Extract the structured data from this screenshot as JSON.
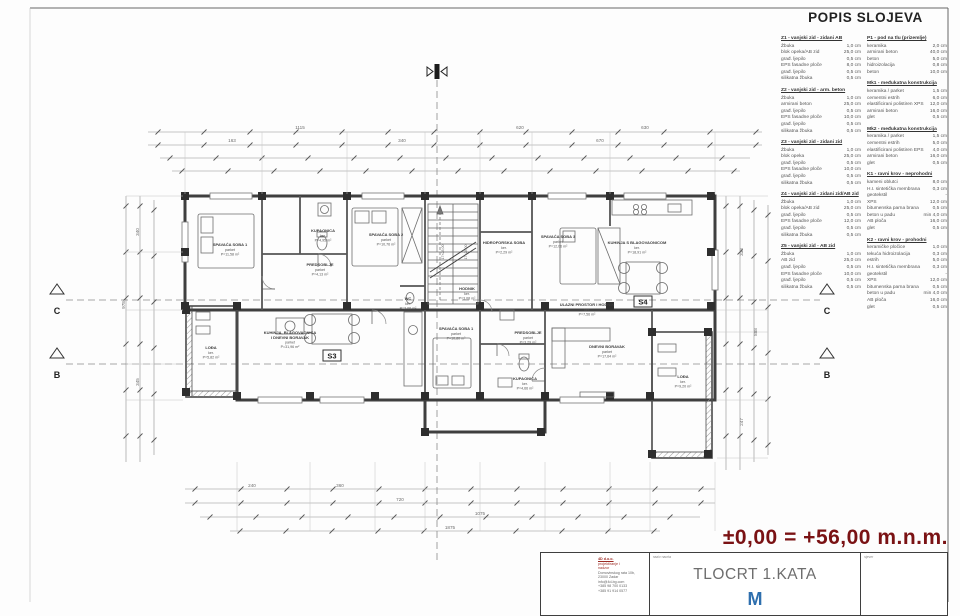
{
  "sheet": {
    "legend_title": "POPIS SLOJEVA",
    "elevation_note": "±0,00 = +56,00  m.n.m.",
    "title_block": {
      "drawing_title": "TLOCRT 1.KATA",
      "scale_prefix": "M",
      "title_cell_label": "naziv nacrta",
      "north_cell_label": "sjever",
      "logo_letter": "D",
      "company": {
        "red_lines": [
          "4D d.o.o.",
          "projektiranje i",
          "nadzor"
        ],
        "gray_lines": [
          "Domovinskog rata 10b,",
          "23000 Zadar",
          "info@4d-bg.com",
          "+385 98 700 0133",
          "+385 91 914 0577"
        ]
      }
    },
    "accent_colors": {
      "red": "#7a1214",
      "blue": "#2e6fae",
      "line": "#3f3f3f"
    }
  },
  "legend": {
    "left": [
      {
        "title": "Z1 - vanjski zid - zidani AB",
        "items": [
          [
            "Žbuka",
            "1,0 cm"
          ],
          [
            "blok opeka/AB zid",
            "25,0 cm"
          ],
          [
            "građ. ljepilo",
            "0,5 cm"
          ],
          [
            "EPS fasadne ploče",
            "8,0 cm"
          ],
          [
            "građ. ljepilo",
            "0,5 cm"
          ],
          [
            "silikatna žbuka",
            "0,5 cm"
          ]
        ]
      },
      {
        "title": "Z2 - vanjski zid - arm. beton",
        "items": [
          [
            "Žbuka",
            "1,0 cm"
          ],
          [
            "armirani beton",
            "25,0 cm"
          ],
          [
            "građ. ljepilo",
            "0,5 cm"
          ],
          [
            "EPS fasadne ploče",
            "10,0 cm"
          ],
          [
            "građ. ljepilo",
            "0,5 cm"
          ],
          [
            "silikatna žbuka",
            "0,5 cm"
          ]
        ]
      },
      {
        "title": "Z3 - vanjski zid - zidani zid",
        "items": [
          [
            "Žbuka",
            "1,0 cm"
          ],
          [
            "blok opeka",
            "25,0 cm"
          ],
          [
            "građ. ljepilo",
            "0,5 cm"
          ],
          [
            "EPS fasadne ploče",
            "10,0 cm"
          ],
          [
            "građ. ljepilo",
            "0,5 cm"
          ],
          [
            "silikatna žbuka",
            "0,5 cm"
          ]
        ]
      },
      {
        "title": "Z4 - vanjski zid - zidani zid/AB zid",
        "items": [
          [
            "Žbuka",
            "1,0 cm"
          ],
          [
            "blok opeka/AB zid",
            "25,0 cm"
          ],
          [
            "građ. ljepilo",
            "0,5 cm"
          ],
          [
            "EPS fasadne ploče",
            "12,0 cm"
          ],
          [
            "građ. ljepilo",
            "0,5 cm"
          ],
          [
            "silikatna žbuka",
            "0,5 cm"
          ]
        ]
      },
      {
        "title": "Z5 - vanjski zid - AB zid",
        "items": [
          [
            "Žbuka",
            "1,0 cm"
          ],
          [
            "AB zid",
            "25,0 cm"
          ],
          [
            "građ. ljepilo",
            "0,5 cm"
          ],
          [
            "EPS fasadne ploče",
            "10,0 cm"
          ],
          [
            "građ. ljepilo",
            "0,5 cm"
          ],
          [
            "silikatna žbuka",
            "0,5 cm"
          ]
        ]
      }
    ],
    "right": [
      {
        "title": "P1 - pod na tlu (prizemlje)",
        "items": [
          [
            "keramika",
            "2,0 cm"
          ],
          [
            "armirani beton",
            "40,0 cm"
          ],
          [
            "beton",
            "5,0 cm"
          ],
          [
            "hidroizolacija",
            "0,8 cm"
          ],
          [
            "beton",
            "10,0 cm"
          ]
        ]
      },
      {
        "title": "Mk1 - međukatna konstrukcija",
        "items": [
          [
            "keramika / parket",
            "1,5 cm"
          ],
          [
            "cementni estrih",
            "6,0 cm"
          ],
          [
            "elastificirani polistiren XPS",
            "12,0 cm"
          ],
          [
            "armirani beton",
            "16,0 cm"
          ],
          [
            "glet",
            "0,5 cm"
          ]
        ]
      },
      {
        "title": "Mk2 - međukatna konstrukcija",
        "items": [
          [
            "keramika / parket",
            "1,5 cm"
          ],
          [
            "cementni estrih",
            "5,0 cm"
          ],
          [
            "elastificirani polistiren EPS",
            "4,0 cm"
          ],
          [
            "armirani beton",
            "16,0 cm"
          ],
          [
            "glet",
            "0,5 cm"
          ]
        ]
      },
      {
        "title": "K1 - ravni krov - neprohodni",
        "items": [
          [
            "kameni oblutci",
            "8,0 cm"
          ],
          [
            "H.I. sintetička membrana",
            "0,3 cm"
          ],
          [
            "geotekstil",
            "-"
          ],
          [
            "XPS",
            "12,0 cm"
          ],
          [
            "bitumenska parna brana",
            "0,5 cm"
          ],
          [
            "beton u padu",
            "min 4,0 cm"
          ],
          [
            "AB ploča",
            "16,0 cm"
          ],
          [
            "glet",
            "0,5 cm"
          ]
        ]
      },
      {
        "title": "K2 - ravni krov - prohodni",
        "items": [
          [
            "keramičke pločice",
            "1,0 cm"
          ],
          [
            "tekuća hidroizolacija",
            "0,3 cm"
          ],
          [
            "estrih",
            "5,0 cm"
          ],
          [
            "H.I. sintetička membrana",
            "0,3 cm"
          ],
          [
            "geotekstil",
            "-"
          ],
          [
            "XPS",
            "12,0 cm"
          ],
          [
            "bitumenska parna brana",
            "0,5 cm"
          ],
          [
            "beton u padu",
            "min 4,0 cm"
          ],
          [
            "AB ploča",
            "16,0 cm"
          ],
          [
            "glet",
            "0,5 cm"
          ]
        ]
      }
    ]
  },
  "plan": {
    "unit_labels": {
      "s3": "S3",
      "s4": "S4"
    },
    "section_markers": {
      "b": "B",
      "c": "C"
    },
    "stairs_text": "17×28,00",
    "dims": {
      "top": [
        "1115",
        "620",
        "630",
        "163",
        "340",
        "670"
      ],
      "bottom": [
        "240",
        "360",
        "720",
        "1075",
        "1875"
      ],
      "left": [
        "340",
        "978",
        "345"
      ],
      "right": [
        "333",
        "888",
        "247"
      ]
    },
    "rooms": [
      {
        "name": "SPAVAĆA SOBA 1",
        "floor": "parket",
        "area": "P=11,58 m²"
      },
      {
        "name": "KUPAONICA",
        "floor": "ker.",
        "area": "P=4,95 m²"
      },
      {
        "name": "PREDSOBLJE",
        "floor": "parket",
        "area": "P=4,13 m²"
      },
      {
        "name": "SPAVAĆA SOBA 2",
        "floor": "parket",
        "area": "P=10,76 m²"
      },
      {
        "name": "HIDROFORSKA SOBA",
        "floor": "ker.",
        "area": "P=2,29 m²"
      },
      {
        "name": "SPAVAĆA SOBA 3",
        "floor": "parket",
        "area": "P=12,06 m²"
      },
      {
        "name": "KUHINJA S BLAGOVAONICOM",
        "floor": "ker.",
        "area": "P=18,91 m²"
      },
      {
        "name": "HODNIK",
        "floor": "ker.",
        "area": "P=3,08 m²"
      },
      {
        "name": "ULAZNI PROSTOR I HODNIK",
        "floor": "ker.",
        "area": "P=7,56 m²"
      },
      {
        "name": "KUHINJA, BLAGOVAONICA",
        "name2": "I DNEVNI BORAVAK",
        "floor": "parket",
        "area": "P=31,96 m²"
      },
      {
        "name": "WC",
        "floor": "ker.",
        "area": "P=2,06 m²"
      },
      {
        "name": "SPAVAĆA SOBA 1",
        "floor": "parket",
        "area": "P=10,80 m²"
      },
      {
        "name": "PREDSOBLJE",
        "floor": "parket",
        "area": "P=3,29 m²"
      },
      {
        "name": "KUPAONICA",
        "floor": "ker.",
        "area": "P=4,66 m²"
      },
      {
        "name": "DNEVNI BORAVAK",
        "floor": "parket",
        "area": "P=17,64 m²"
      },
      {
        "name": "LOĐA",
        "floor": "ker.",
        "area": "P=9,20 m²"
      },
      {
        "name": "LOĐA",
        "floor": "ker.",
        "area": "P=5,82 m²"
      }
    ]
  }
}
